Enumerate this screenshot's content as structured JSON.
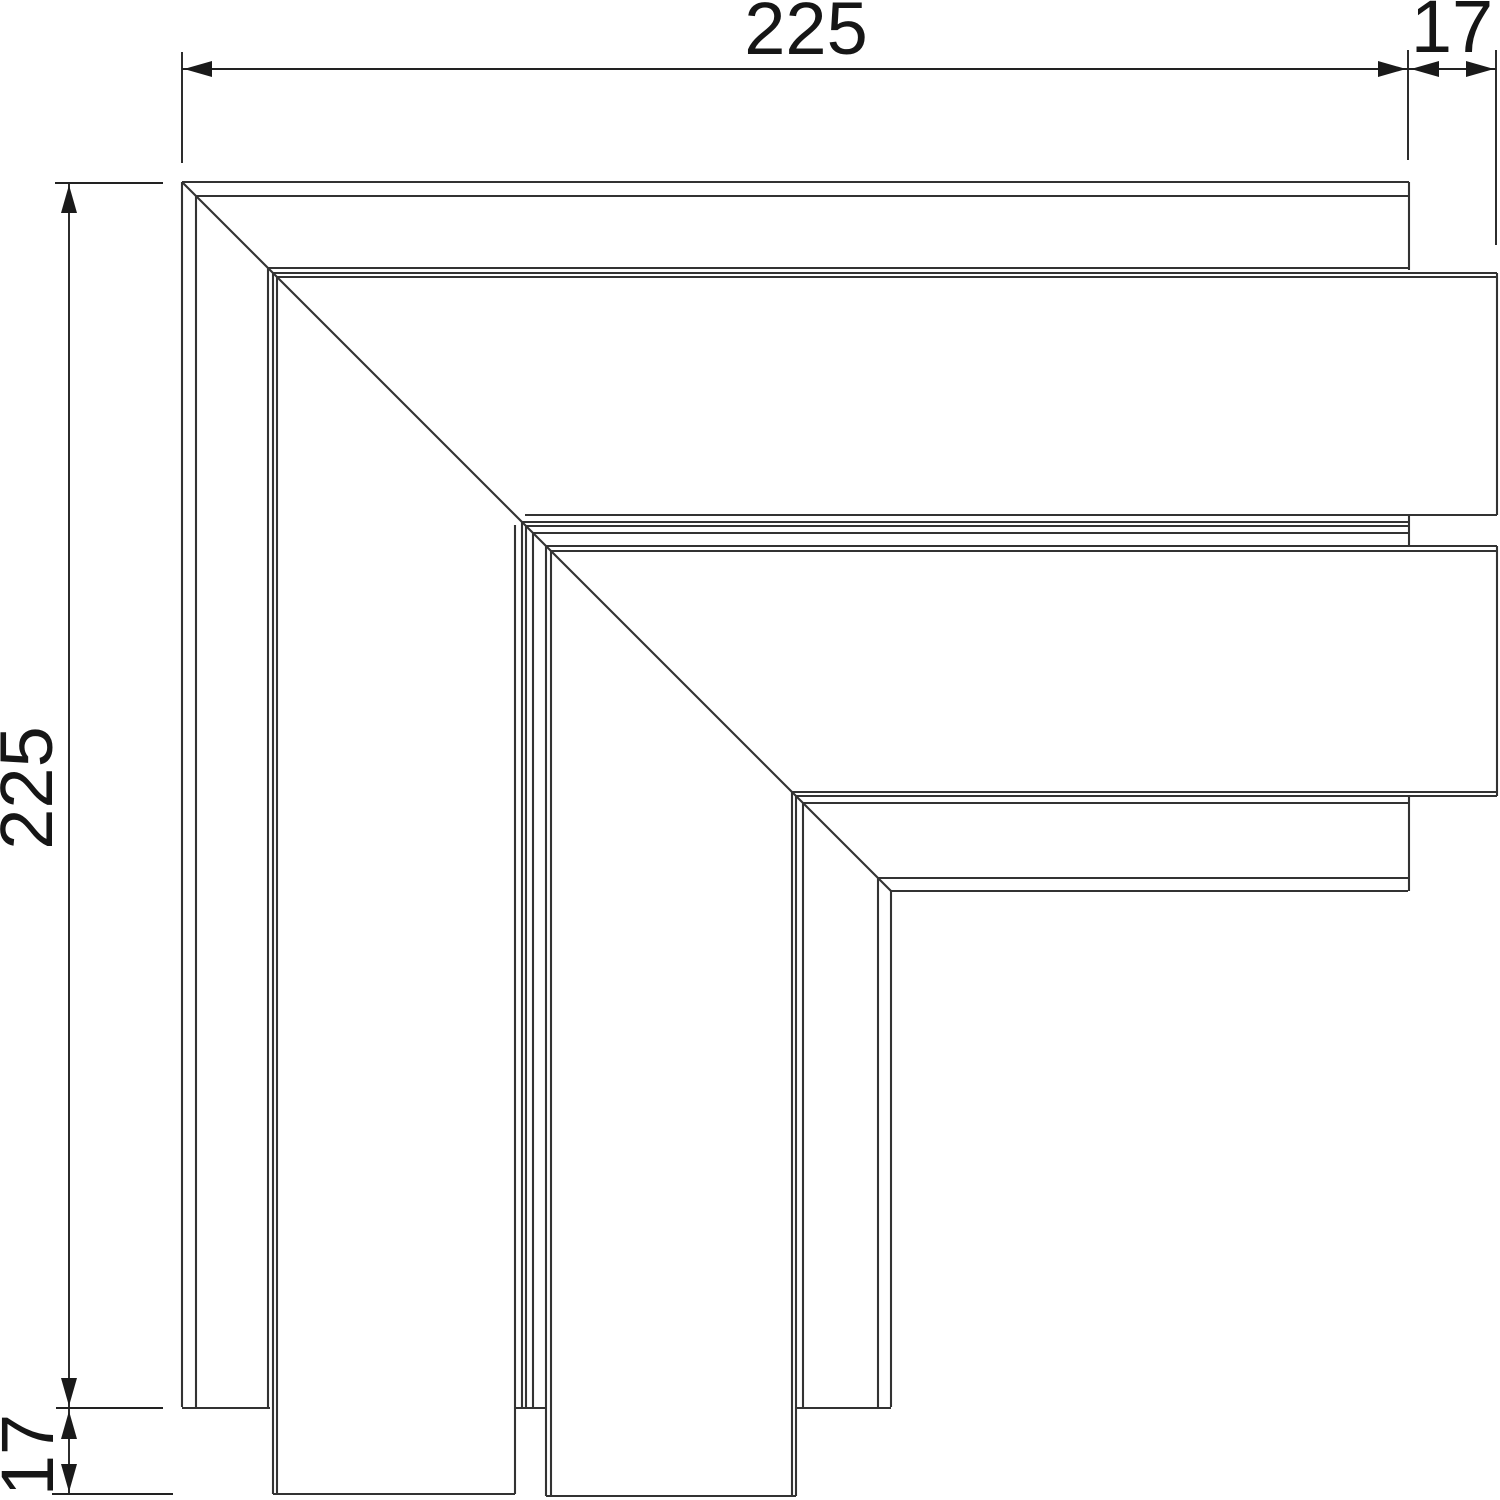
{
  "dimensions": {
    "top_width": {
      "label": "225",
      "x": 806,
      "y": 29,
      "rotated": false
    },
    "top_overlap": {
      "label": "17",
      "x": 1452,
      "y": 27,
      "rotated": false
    },
    "left_height": {
      "label": "225",
      "x": 27,
      "y": 788,
      "rotated": true
    },
    "left_overlap": {
      "label": "17",
      "x": 28,
      "y": 1455,
      "rotated": true
    }
  },
  "style": {
    "background": "#ffffff",
    "part_line_color": "#333333",
    "dim_line_color": "#222222",
    "arrow_color": "#1a1a1a",
    "text_color": "#161616",
    "part_stroke_width": 2.1,
    "dim_stroke_width": 1.9
  },
  "drawing": {
    "canvas": {
      "width": 1500,
      "height": 1500
    },
    "part_segments": [
      [
        182,
        182,
        1409,
        182
      ],
      [
        196,
        196,
        1409,
        196
      ],
      [
        268,
        268,
        1409,
        268
      ],
      [
        273,
        273,
        1497,
        273
      ],
      [
        277,
        277,
        1497,
        277
      ],
      [
        525,
        515,
        1497,
        515
      ],
      [
        522,
        522,
        1409,
        522
      ],
      [
        526,
        526,
        1409,
        526
      ],
      [
        533,
        533,
        1409,
        533
      ],
      [
        546,
        546,
        1497,
        546
      ],
      [
        551,
        551,
        1497,
        551
      ],
      [
        792,
        792,
        1497,
        792
      ],
      [
        796,
        796,
        1497,
        796
      ],
      [
        803,
        803,
        1409,
        803
      ],
      [
        878,
        878,
        1408,
        878
      ],
      [
        891,
        891,
        1408,
        891
      ],
      [
        182,
        182,
        182,
        1407
      ],
      [
        196,
        196,
        196,
        1407
      ],
      [
        268,
        268,
        268,
        1407
      ],
      [
        273,
        273,
        273,
        1494
      ],
      [
        277,
        277,
        277,
        1494
      ],
      [
        515,
        525,
        515,
        1494
      ],
      [
        522,
        522,
        522,
        1407
      ],
      [
        526,
        526,
        526,
        1407
      ],
      [
        533,
        533,
        533,
        1407
      ],
      [
        546,
        546,
        546,
        1496
      ],
      [
        551,
        551,
        551,
        1496
      ],
      [
        792,
        792,
        792,
        1496
      ],
      [
        796,
        796,
        796,
        1496
      ],
      [
        803,
        803,
        803,
        1407
      ],
      [
        878,
        878,
        878,
        1407
      ],
      [
        891,
        891,
        891,
        1407
      ],
      [
        1409,
        182,
        1409,
        270
      ],
      [
        1409,
        515,
        1409,
        546
      ],
      [
        1409,
        797,
        1409,
        891
      ],
      [
        1497,
        273,
        1497,
        515
      ],
      [
        1497,
        546,
        1497,
        796
      ],
      [
        182,
        1408,
        270,
        1408
      ],
      [
        515,
        1408,
        546,
        1408
      ],
      [
        797,
        1408,
        891,
        1408
      ],
      [
        273,
        1494,
        515,
        1494
      ],
      [
        546,
        1496,
        796,
        1496
      ],
      [
        182,
        182,
        891,
        891
      ]
    ],
    "dim_segments": [
      [
        182,
        52,
        182,
        163
      ],
      [
        1408,
        50,
        1408,
        160
      ],
      [
        1496,
        50,
        1496,
        245
      ],
      [
        55,
        183,
        163,
        183
      ],
      [
        56,
        1408,
        163,
        1408
      ],
      [
        52,
        1494,
        173,
        1494
      ],
      [
        182,
        69,
        1496,
        69
      ],
      [
        69,
        183,
        69,
        1494
      ]
    ],
    "arrows": [
      {
        "x": 184,
        "y": 69,
        "dir": "left"
      },
      {
        "x": 1406,
        "y": 69,
        "dir": "right"
      },
      {
        "x": 1411,
        "y": 69,
        "dir": "left"
      },
      {
        "x": 1494,
        "y": 69,
        "dir": "right"
      },
      {
        "x": 69,
        "y": 185,
        "dir": "up"
      },
      {
        "x": 69,
        "y": 1406,
        "dir": "down"
      },
      {
        "x": 69,
        "y": 1411,
        "dir": "up"
      },
      {
        "x": 69,
        "y": 1492,
        "dir": "down"
      }
    ],
    "arrow_shape": {
      "length": 28,
      "half_width": 8
    }
  }
}
